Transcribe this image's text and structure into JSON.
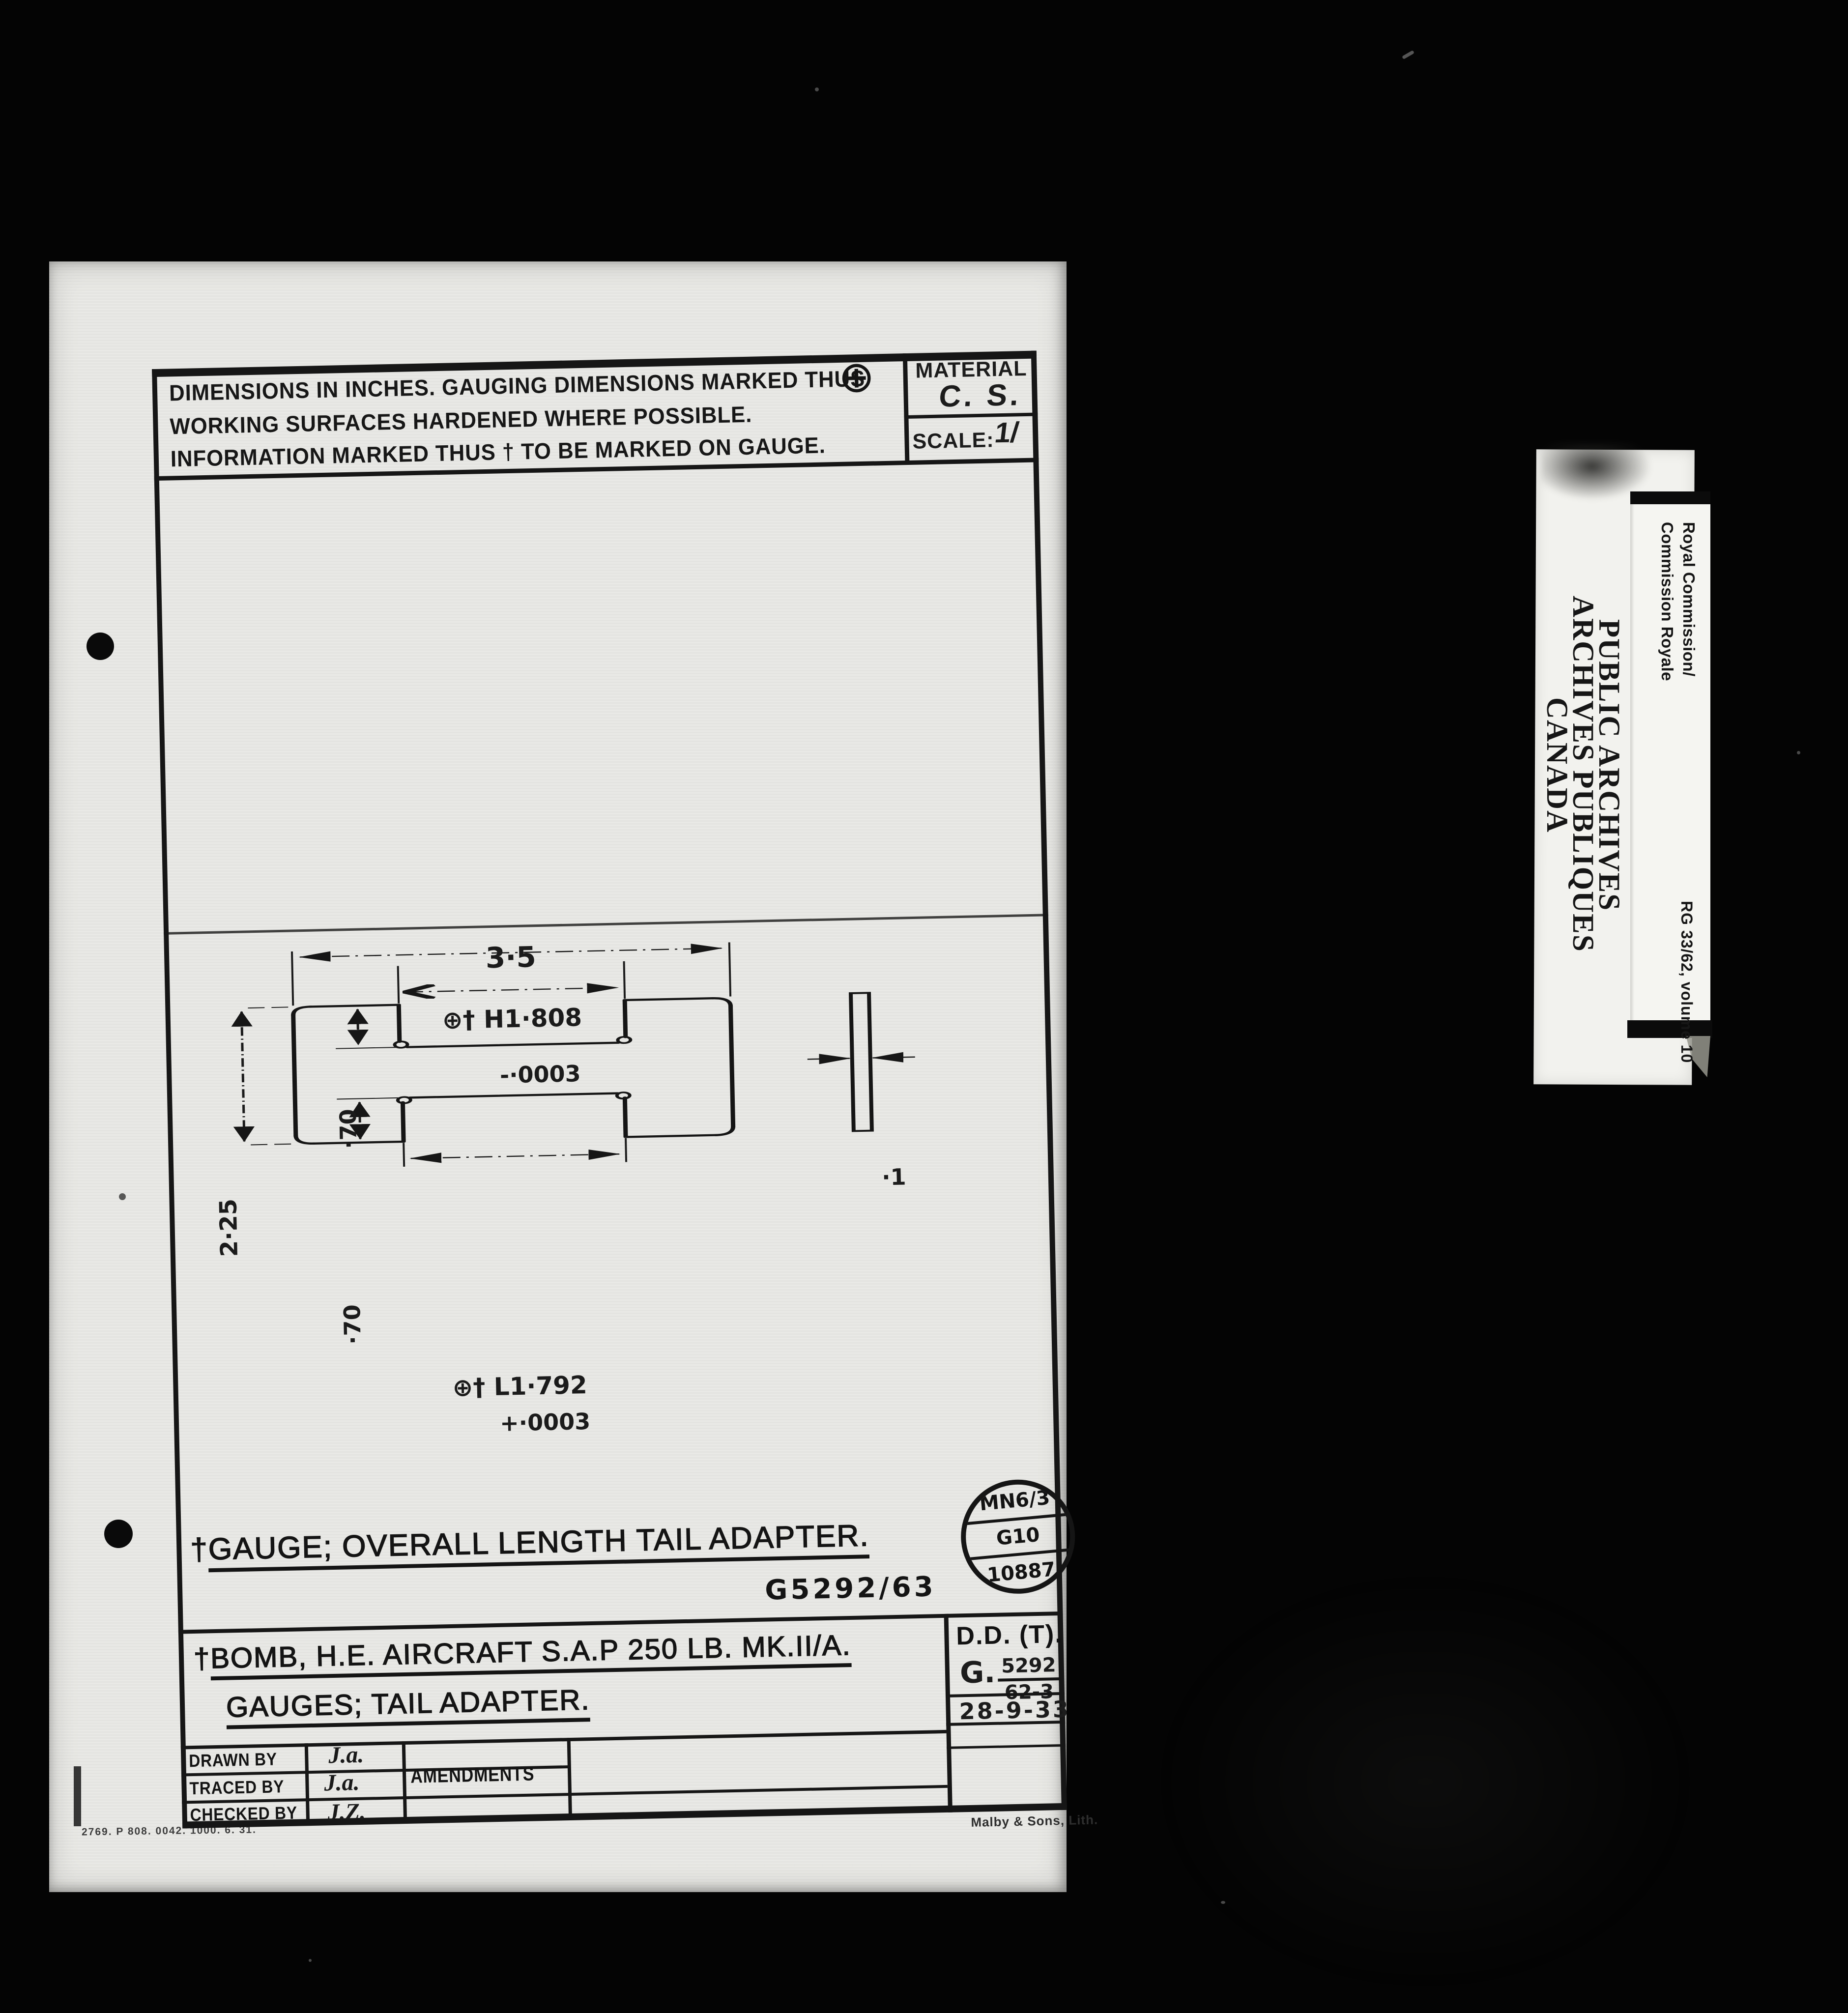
{
  "colors": {
    "background": "#040404",
    "paper": "#e9e9e5",
    "ink": "#1c1c1c",
    "label_paper": "#f2f2ee"
  },
  "header": {
    "notes": [
      "DIMENSIONS IN INCHES. GAUGING DIMENSIONS MARKED THUS",
      "WORKING SURFACES HARDENED WHERE POSSIBLE.",
      "INFORMATION MARKED THUS † TO BE MARKED ON GAUGE."
    ],
    "gauging_symbol": "⊕",
    "material_label": "MATERIAL",
    "material_value": "C. S.",
    "scale_label": "SCALE:",
    "scale_value": "1/"
  },
  "drawing": {
    "overall_width": "3·5",
    "slot_high": "⊕† H1·808",
    "slot_high_tol": "-·0003",
    "slot_low": "⊕† L1·792",
    "slot_low_tol": "+·0003",
    "height": "2·25",
    "depth_top": "·70",
    "depth_bottom": "·70",
    "thickness": "·1"
  },
  "titles": {
    "dagger": "†",
    "gauge_title": "GAUGE; OVERALL LENGTH TAIL ADAPTER.",
    "drawing_number": "G5292/63",
    "bomb_title": "BOMB, H.E. AIRCRAFT S.A.P 250 LB. MK.II/A.",
    "bomb_subtitle": "GAUGES; TAIL ADAPTER."
  },
  "stamp": {
    "line1": "MN6/3",
    "line2": "G10",
    "line3": "10887"
  },
  "approval": {
    "dd": "D.D. (T).",
    "g_prefix": "G.",
    "g_top": "5292",
    "g_bottom": "62-3",
    "date": "28-9-33"
  },
  "table": {
    "amendments_label": "AMENDMENTS",
    "rows": [
      {
        "label": "DRAWN BY",
        "sig": "J.a."
      },
      {
        "label": "TRACED BY",
        "sig": "J.a."
      },
      {
        "label": "CHECKED BY",
        "sig": "J.Z."
      }
    ]
  },
  "footer": {
    "print_code": "2769. P 808. 0042. 1000. 6. 31.",
    "printer": "Malby & Sons, Lith."
  },
  "archive_label": {
    "royal_lines": [
      "Royal Commission/",
      "Commission Royale"
    ],
    "archive_lines": [
      "PUBLIC ARCHIVES",
      "ARCHIVES PUBLIQUES",
      "CANADA"
    ],
    "reference": "RG 33/62, volume 10"
  }
}
